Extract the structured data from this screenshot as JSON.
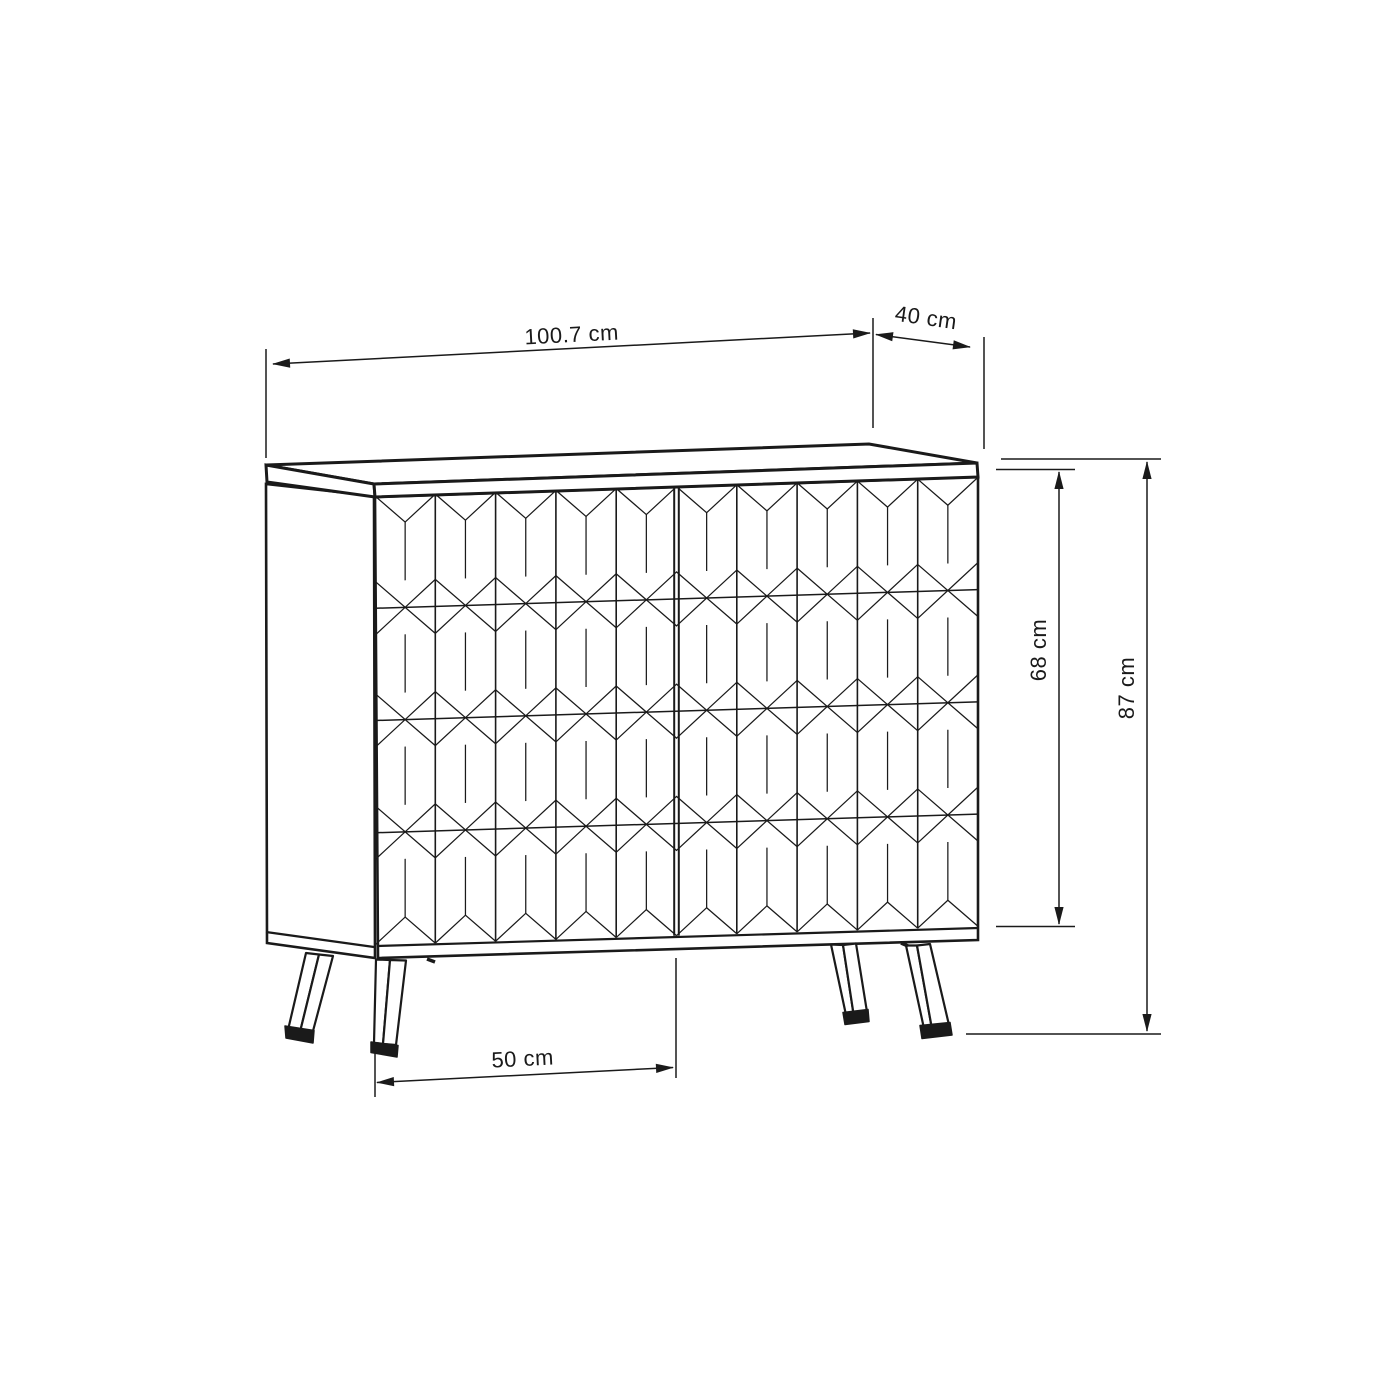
{
  "colors": {
    "ink": "#1a1a1a",
    "background": "#ffffff"
  },
  "drawing": {
    "type": "furniture dimension diagram",
    "subject": "two-door sideboard with faceted geometric front and splayed legs",
    "units": "cm",
    "dimensions": {
      "top_width": {
        "label": "100.7 cm",
        "value": 100.7
      },
      "top_depth": {
        "label": "40 cm",
        "value": 40
      },
      "body_height": {
        "label": "68 cm",
        "value": 68
      },
      "total_height": {
        "label": "87 cm",
        "value": 87
      },
      "leg_span": {
        "label": "50 cm",
        "value": 50
      }
    },
    "pattern": {
      "style": "elongated hexagons with diamond facets",
      "doors": 2,
      "columns_per_door": 5,
      "rows": 4
    }
  }
}
